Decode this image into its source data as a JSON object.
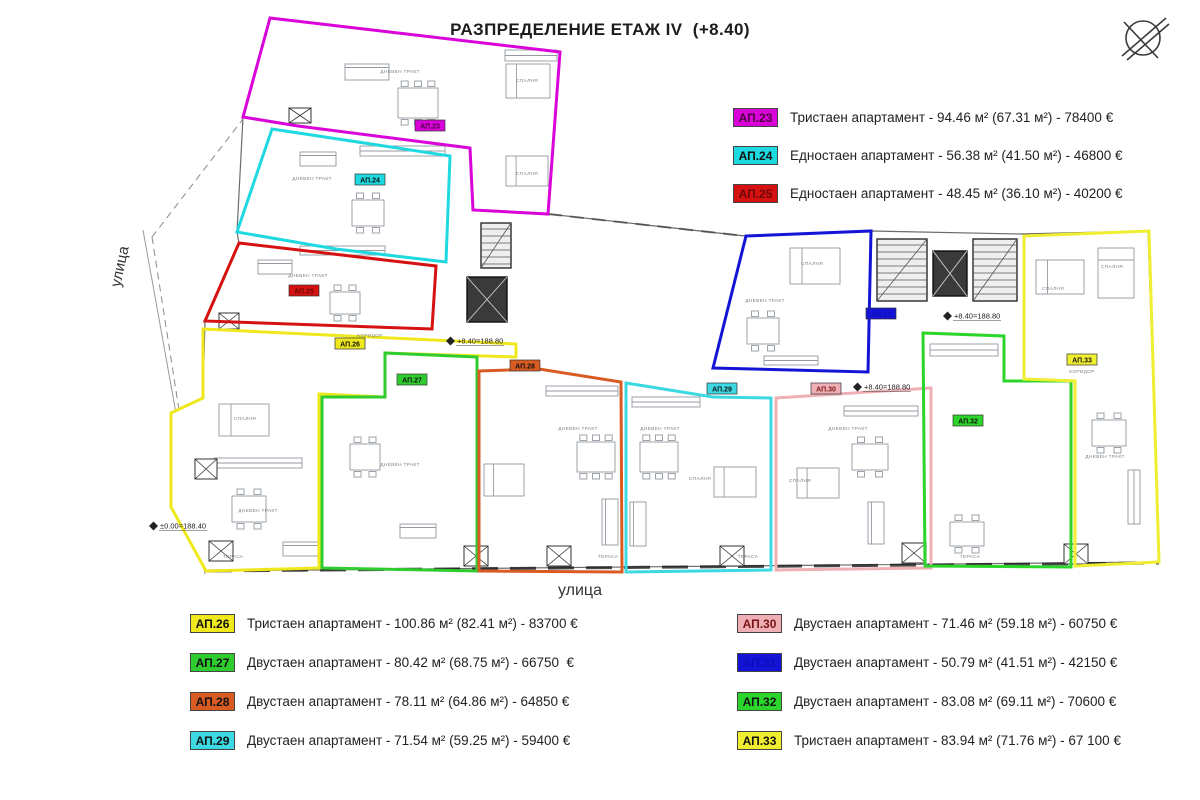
{
  "title": "РАЗПРЕДЕЛЕНИЕ ЕТАЖ IV  (+8.40)",
  "streets": {
    "left": "улица",
    "bottom": "улица"
  },
  "legend_top": [
    {
      "id": "АП.23",
      "color": "#d902d9",
      "text_color": "#4d0040",
      "label": "Тристаен апартамент - 94.46 м² (67.31 м²) - 78400 €"
    },
    {
      "id": "АП.24",
      "color": "#1fd9e0",
      "text_color": "#111111",
      "label": "Едностаен апартамент - 56.38 м² (41.50 м²) - 46800 €"
    },
    {
      "id": "АП.25",
      "color": "#d61111",
      "text_color": "#6e0606",
      "label": "Едностаен апартамент - 48.45 м² (36.10 м²) - 40200 €"
    }
  ],
  "legend_bottom_left": [
    {
      "id": "АП.26",
      "color": "#efe81c",
      "text_color": "#111111",
      "label": "Тристаен апартамент - 100.86 м² (82.41 м²) - 83700 €"
    },
    {
      "id": "АП.27",
      "color": "#2fcc2f",
      "text_color": "#111111",
      "label": "Двустаен апартамент - 80.42 м² (68.75 м²) - 66750  €"
    },
    {
      "id": "АП.28",
      "color": "#d85c22",
      "text_color": "#111111",
      "label": "Двустаен апартамент - 78.11 м² (64.86 м²) - 64850 €"
    },
    {
      "id": "АП.29",
      "color": "#3cd9e2",
      "text_color": "#111111",
      "label": "Двустаен апартамент - 71.54 м² (59.25 м²) - 59400 €"
    }
  ],
  "legend_bottom_right": [
    {
      "id": "АП.30",
      "color": "#eeb0b4",
      "text_color": "#7a1515",
      "label": "Двустаен апартамент - 71.46 м² (59.18 м²) - 60750 €"
    },
    {
      "id": "АП.31",
      "color": "#1414d6",
      "text_color": "#0d0dbb",
      "label": "Двустаен апартамент - 50.79 м² (41.51 м²) - 42150 €"
    },
    {
      "id": "АП.32",
      "color": "#2bd52b",
      "text_color": "#111111",
      "label": "Двустаен апартамент - 83.08 м² (69.11 м²) - 70600 €"
    },
    {
      "id": "АП.33",
      "color": "#f0ee30",
      "text_color": "#111111",
      "label": "Тристаен апартамент - 83.94 м² (71.76 м²) - 67 100 €"
    }
  ],
  "plan": {
    "outline": [
      [
        270,
        18
      ],
      [
        560,
        52
      ],
      [
        548,
        214
      ],
      [
        745,
        236
      ],
      [
        872,
        231
      ],
      [
        1020,
        234
      ],
      [
        1148,
        231
      ],
      [
        1159,
        562
      ],
      [
        206,
        571
      ],
      [
        171,
        507
      ],
      [
        171,
        413
      ],
      [
        203,
        398
      ],
      [
        205,
        321
      ],
      [
        239,
        243
      ],
      [
        237,
        232
      ],
      [
        243,
        117
      ]
    ],
    "dashed_lines": [
      [
        [
          152,
          237
        ],
        [
          243,
          119
        ]
      ],
      [
        [
          152,
          237
        ],
        [
          204,
          570
        ]
      ]
    ],
    "solid_lines": [
      [
        [
          143,
          230
        ],
        [
          205,
          574
        ]
      ],
      [
        [
          548,
          214
        ],
        [
          745,
          236
        ]
      ]
    ],
    "apartments": [
      {
        "id": "АП.23",
        "color": "#d902d9",
        "chip_text": "#4d0040",
        "chip": [
          430,
          126
        ],
        "outline": [
          [
            270,
            18
          ],
          [
            560,
            52
          ],
          [
            548,
            214
          ],
          [
            473,
            210
          ],
          [
            470,
            148
          ],
          [
            298,
            126
          ],
          [
            243,
            117
          ]
        ]
      },
      {
        "id": "АП.24",
        "color": "#1fd9e0",
        "chip_text": "#111111",
        "chip": [
          370,
          180
        ],
        "outline": [
          [
            272,
            129
          ],
          [
            450,
            156
          ],
          [
            446,
            262
          ],
          [
            336,
            249
          ],
          [
            237,
            232
          ]
        ]
      },
      {
        "id": "АП.25",
        "color": "#d61111",
        "chip_text": "#6e0606",
        "chip": [
          304,
          291
        ],
        "outline": [
          [
            239,
            243
          ],
          [
            436,
            266
          ],
          [
            432,
            329
          ],
          [
            205,
            321
          ]
        ]
      },
      {
        "id": "АП.26",
        "color": "#efe81c",
        "chip_text": "#111111",
        "chip": [
          350,
          344
        ],
        "outline": [
          [
            203,
            329
          ],
          [
            516,
            344
          ],
          [
            516,
            357
          ],
          [
            385,
            353
          ],
          [
            385,
            397
          ],
          [
            319,
            394
          ],
          [
            319,
            568
          ],
          [
            206,
            571
          ],
          [
            171,
            507
          ],
          [
            171,
            413
          ],
          [
            203,
            398
          ]
        ]
      },
      {
        "id": "АП.27",
        "color": "#2fcc2f",
        "chip_text": "#111111",
        "chip": [
          412,
          380
        ],
        "outline": [
          [
            385,
            353
          ],
          [
            477,
            357
          ],
          [
            477,
            571
          ],
          [
            322,
            568
          ],
          [
            322,
            397
          ],
          [
            385,
            397
          ]
        ]
      },
      {
        "id": "АП.28",
        "color": "#d85c22",
        "chip_text": "#111111",
        "chip": [
          525,
          366
        ],
        "outline": [
          [
            479,
            371
          ],
          [
            539,
            369
          ],
          [
            621,
            382
          ],
          [
            622,
            572
          ],
          [
            479,
            571
          ]
        ]
      },
      {
        "id": "АП.29",
        "color": "#3cd9e2",
        "chip_text": "#111111",
        "chip": [
          722,
          389
        ],
        "outline": [
          [
            626,
            383
          ],
          [
            713,
            397
          ],
          [
            771,
            398
          ],
          [
            771,
            570
          ],
          [
            626,
            572
          ]
        ]
      },
      {
        "id": "АП.30",
        "color": "#eeb0b4",
        "chip_text": "#7a1515",
        "chip": [
          826,
          389
        ],
        "outline": [
          [
            776,
            398
          ],
          [
            931,
            388
          ],
          [
            931,
            568
          ],
          [
            776,
            570
          ]
        ]
      },
      {
        "id": "АП.31",
        "color": "#1414d6",
        "chip_text": "#0d0dbb",
        "chip": [
          881,
          314
        ],
        "outline": [
          [
            746,
            236
          ],
          [
            871,
            231
          ],
          [
            868,
            372
          ],
          [
            713,
            368
          ]
        ]
      },
      {
        "id": "АП.32",
        "color": "#2bd52b",
        "chip_text": "#111111",
        "chip": [
          968,
          421
        ],
        "outline": [
          [
            923,
            333
          ],
          [
            1004,
            336
          ],
          [
            1004,
            381
          ],
          [
            1071,
            381
          ],
          [
            1071,
            567
          ],
          [
            925,
            566
          ]
        ]
      },
      {
        "id": "АП.33",
        "color": "#f0ee30",
        "chip_text": "#111111",
        "chip": [
          1082,
          360
        ],
        "outline": [
          [
            1024,
            236
          ],
          [
            1149,
            231
          ],
          [
            1159,
            562
          ],
          [
            1075,
            566
          ],
          [
            1075,
            381
          ],
          [
            1024,
            379
          ]
        ]
      }
    ],
    "elevation_markers": [
      {
        "text": "+8.40=188.80",
        "x": 455,
        "y": 341
      },
      {
        "text": "+8.40=188.80",
        "x": 862,
        "y": 387
      },
      {
        "text": "+8.40=188.80",
        "x": 952,
        "y": 316
      },
      {
        "text": "±0.00=188.40",
        "x": 158,
        "y": 526
      }
    ],
    "room_labels": [
      {
        "t": "ДНЕВЕН ТРАКТ",
        "x": 400,
        "y": 73
      },
      {
        "t": "СПАЛНЯ",
        "x": 527,
        "y": 82
      },
      {
        "t": "СПАЛНЯ",
        "x": 527,
        "y": 175
      },
      {
        "t": "ДНЕВЕН ТРАКТ",
        "x": 312,
        "y": 180
      },
      {
        "t": "ДНЕВЕН ТРАКТ",
        "x": 308,
        "y": 277
      },
      {
        "t": "СПАЛНЯ",
        "x": 245,
        "y": 420
      },
      {
        "t": "ДНЕВЕН ТРАКТ",
        "x": 258,
        "y": 512
      },
      {
        "t": "ДНЕВЕН ТРАКТ",
        "x": 400,
        "y": 466
      },
      {
        "t": "ДНЕВЕН ТРАКТ",
        "x": 578,
        "y": 430
      },
      {
        "t": "ДНЕВЕН ТРАКТ",
        "x": 660,
        "y": 430
      },
      {
        "t": "ДНЕВЕН ТРАКТ",
        "x": 848,
        "y": 430
      },
      {
        "t": "СПАЛНЯ",
        "x": 700,
        "y": 480
      },
      {
        "t": "СПАЛНЯ",
        "x": 800,
        "y": 482
      },
      {
        "t": "СПАЛНЯ",
        "x": 812,
        "y": 265
      },
      {
        "t": "ДНЕВЕН ТРАКТ",
        "x": 765,
        "y": 302
      },
      {
        "t": "СПАЛНЯ",
        "x": 1053,
        "y": 290
      },
      {
        "t": "СПАЛНЯ",
        "x": 1112,
        "y": 268
      },
      {
        "t": "КОРИДОР",
        "x": 1082,
        "y": 373
      },
      {
        "t": "КОРИДОР",
        "x": 370,
        "y": 337
      },
      {
        "t": "ДНЕВЕН ТРАКТ",
        "x": 1105,
        "y": 458
      },
      {
        "t": "ТЕРАСА",
        "x": 233,
        "y": 558
      },
      {
        "t": "ТЕРАСА",
        "x": 608,
        "y": 558
      },
      {
        "t": "ТЕРАСА",
        "x": 748,
        "y": 558
      },
      {
        "t": "ТЕРАСА",
        "x": 970,
        "y": 558
      }
    ],
    "furniture": [
      {
        "type": "table",
        "x": 398,
        "y": 88,
        "w": 40,
        "h": 30
      },
      {
        "type": "table",
        "x": 352,
        "y": 200,
        "w": 32,
        "h": 26
      },
      {
        "type": "table",
        "x": 330,
        "y": 292,
        "w": 30,
        "h": 22
      },
      {
        "type": "table",
        "x": 232,
        "y": 496,
        "w": 34,
        "h": 26
      },
      {
        "type": "table",
        "x": 350,
        "y": 444,
        "w": 30,
        "h": 26
      },
      {
        "type": "table",
        "x": 577,
        "y": 442,
        "w": 38,
        "h": 30
      },
      {
        "type": "table",
        "x": 640,
        "y": 442,
        "w": 38,
        "h": 30
      },
      {
        "type": "table",
        "x": 852,
        "y": 444,
        "w": 36,
        "h": 26
      },
      {
        "type": "table",
        "x": 747,
        "y": 318,
        "w": 32,
        "h": 26
      },
      {
        "type": "table",
        "x": 950,
        "y": 522,
        "w": 34,
        "h": 24
      },
      {
        "type": "table",
        "x": 1092,
        "y": 420,
        "w": 34,
        "h": 26
      },
      {
        "type": "bed",
        "x": 506,
        "y": 64,
        "w": 44,
        "h": 34
      },
      {
        "type": "bed",
        "x": 506,
        "y": 156,
        "w": 42,
        "h": 30
      },
      {
        "type": "bed",
        "x": 219,
        "y": 404,
        "w": 50,
        "h": 32
      },
      {
        "type": "bed",
        "x": 484,
        "y": 464,
        "w": 40,
        "h": 32
      },
      {
        "type": "bed",
        "x": 714,
        "y": 467,
        "w": 42,
        "h": 30
      },
      {
        "type": "bed",
        "x": 797,
        "y": 468,
        "w": 42,
        "h": 30
      },
      {
        "type": "bed",
        "x": 790,
        "y": 248,
        "w": 50,
        "h": 36
      },
      {
        "type": "bed",
        "x": 1036,
        "y": 260,
        "w": 48,
        "h": 34
      },
      {
        "type": "bed",
        "x": 1098,
        "y": 248,
        "w": 36,
        "h": 50
      },
      {
        "type": "sofa",
        "x": 345,
        "y": 64,
        "w": 44,
        "h": 16
      },
      {
        "type": "sofa",
        "x": 300,
        "y": 152,
        "w": 36,
        "h": 14
      },
      {
        "type": "sofa",
        "x": 258,
        "y": 260,
        "w": 34,
        "h": 14
      },
      {
        "type": "sofa",
        "x": 283,
        "y": 542,
        "w": 40,
        "h": 14
      },
      {
        "type": "sofa",
        "x": 400,
        "y": 524,
        "w": 36,
        "h": 14
      },
      {
        "type": "sofa",
        "x": 602,
        "y": 499,
        "w": 16,
        "h": 46
      },
      {
        "type": "sofa",
        "x": 630,
        "y": 502,
        "w": 16,
        "h": 44
      },
      {
        "type": "sofa",
        "x": 868,
        "y": 502,
        "w": 16,
        "h": 42
      },
      {
        "type": "counter",
        "x": 505,
        "y": 50,
        "w": 52,
        "h": 11
      },
      {
        "type": "counter",
        "x": 360,
        "y": 146,
        "w": 85,
        "h": 10
      },
      {
        "type": "counter",
        "x": 300,
        "y": 246,
        "w": 85,
        "h": 9
      },
      {
        "type": "counter",
        "x": 214,
        "y": 458,
        "w": 88,
        "h": 10
      },
      {
        "type": "counter",
        "x": 546,
        "y": 386,
        "w": 72,
        "h": 10
      },
      {
        "type": "counter",
        "x": 632,
        "y": 397,
        "w": 68,
        "h": 10
      },
      {
        "type": "counter",
        "x": 844,
        "y": 406,
        "w": 74,
        "h": 10
      },
      {
        "type": "counter",
        "x": 930,
        "y": 344,
        "w": 68,
        "h": 12
      },
      {
        "type": "counter",
        "x": 764,
        "y": 356,
        "w": 54,
        "h": 9
      },
      {
        "type": "counter",
        "x": 1128,
        "y": 470,
        "w": 12,
        "h": 54
      },
      {
        "type": "stairs",
        "x": 481,
        "y": 223,
        "w": 30,
        "h": 45
      },
      {
        "type": "stairs",
        "x": 877,
        "y": 239,
        "w": 50,
        "h": 62
      },
      {
        "type": "stairs",
        "x": 973,
        "y": 239,
        "w": 44,
        "h": 62
      },
      {
        "type": "lift",
        "x": 467,
        "y": 277,
        "w": 40,
        "h": 45
      },
      {
        "type": "lift",
        "x": 933,
        "y": 251,
        "w": 34,
        "h": 45
      },
      {
        "type": "xbox",
        "x": 219,
        "y": 313,
        "w": 20,
        "h": 16
      },
      {
        "type": "xbox",
        "x": 289,
        "y": 108,
        "w": 22,
        "h": 15
      },
      {
        "type": "xbox",
        "x": 195,
        "y": 459,
        "w": 22,
        "h": 20
      },
      {
        "type": "xbox",
        "x": 209,
        "y": 541,
        "w": 24,
        "h": 20
      },
      {
        "type": "xbox",
        "x": 464,
        "y": 546,
        "w": 24,
        "h": 20
      },
      {
        "type": "xbox",
        "x": 547,
        "y": 546,
        "w": 24,
        "h": 20
      },
      {
        "type": "xbox",
        "x": 720,
        "y": 546,
        "w": 24,
        "h": 20
      },
      {
        "type": "xbox",
        "x": 902,
        "y": 543,
        "w": 24,
        "h": 20
      },
      {
        "type": "xbox",
        "x": 1064,
        "y": 544,
        "w": 24,
        "h": 20
      }
    ]
  }
}
